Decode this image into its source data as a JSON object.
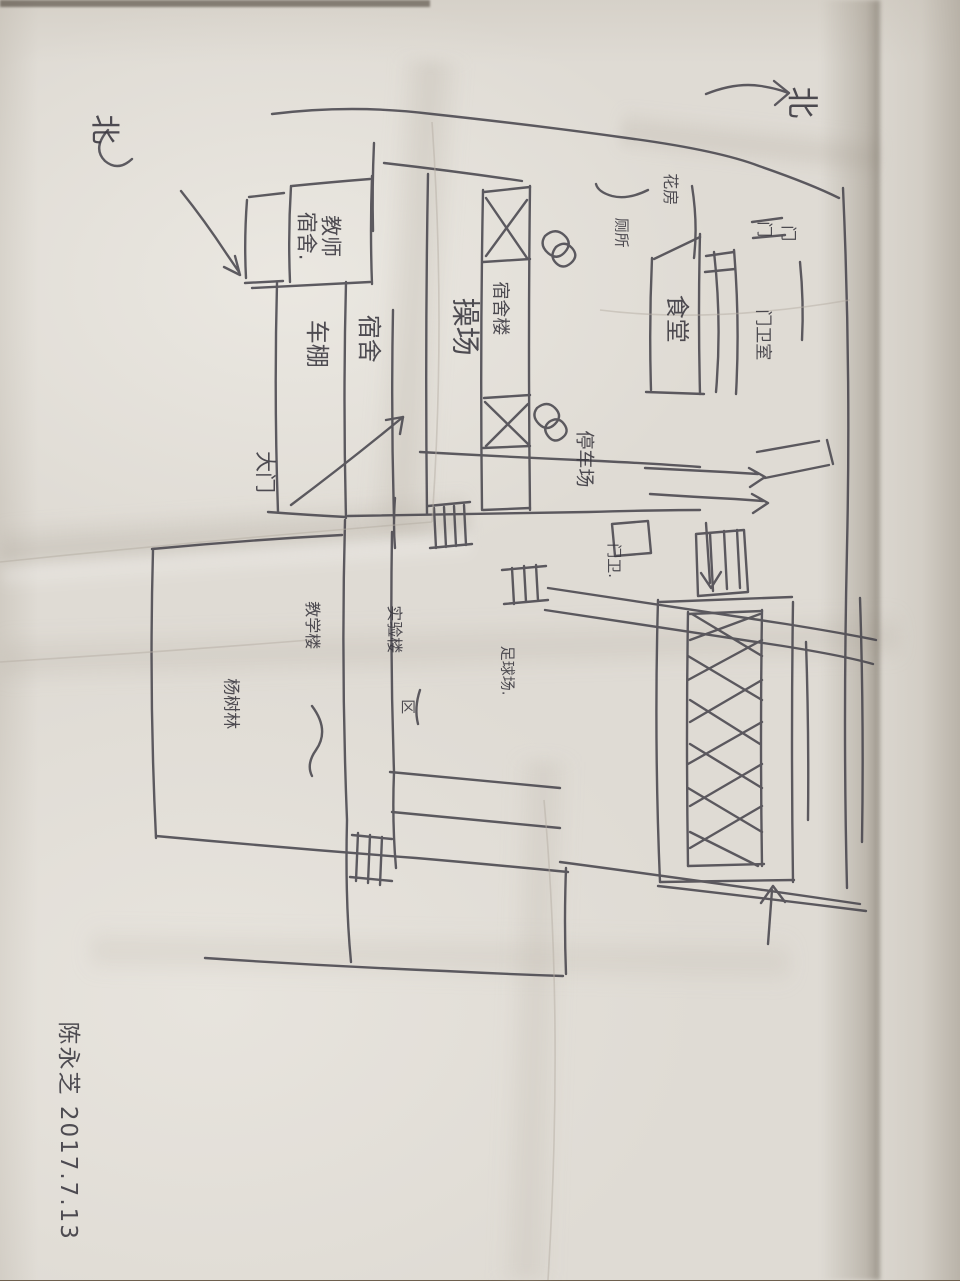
{
  "description": "Photograph of a hand-drawn campus sketch map in ink on wrinkled white paper, drawing rotated 90 degrees in the photo",
  "compass": {
    "north_top_right": "北",
    "north_top_left": "北"
  },
  "labels": {
    "teacher_dorm": "教师\n宿舍.",
    "bike_shed": "车棚",
    "dorm": "宿舍",
    "main_gate": "大门",
    "playground": "操场",
    "dorm_building": "宿舍楼",
    "canteen": "食堂",
    "flower_house": "花房",
    "toilet": "厕所",
    "gate_char_a": "门",
    "gate_char_b": "门",
    "gate_house": "门卫室",
    "parking_lot": "停车场",
    "gate_keeper": "门卫.",
    "teaching_building": "教学楼",
    "lab_building": "实验楼",
    "football_field": "足球场.",
    "area_char": "区",
    "poplar_grove": "杨树林"
  },
  "signature": {
    "name": "陈永芝",
    "date": "2017.7.13",
    "combined": "陈永芝 2017.7.13"
  },
  "colors": {
    "ink": "#44424a",
    "paper": "#dfdbd4",
    "table": "#8a7860"
  }
}
